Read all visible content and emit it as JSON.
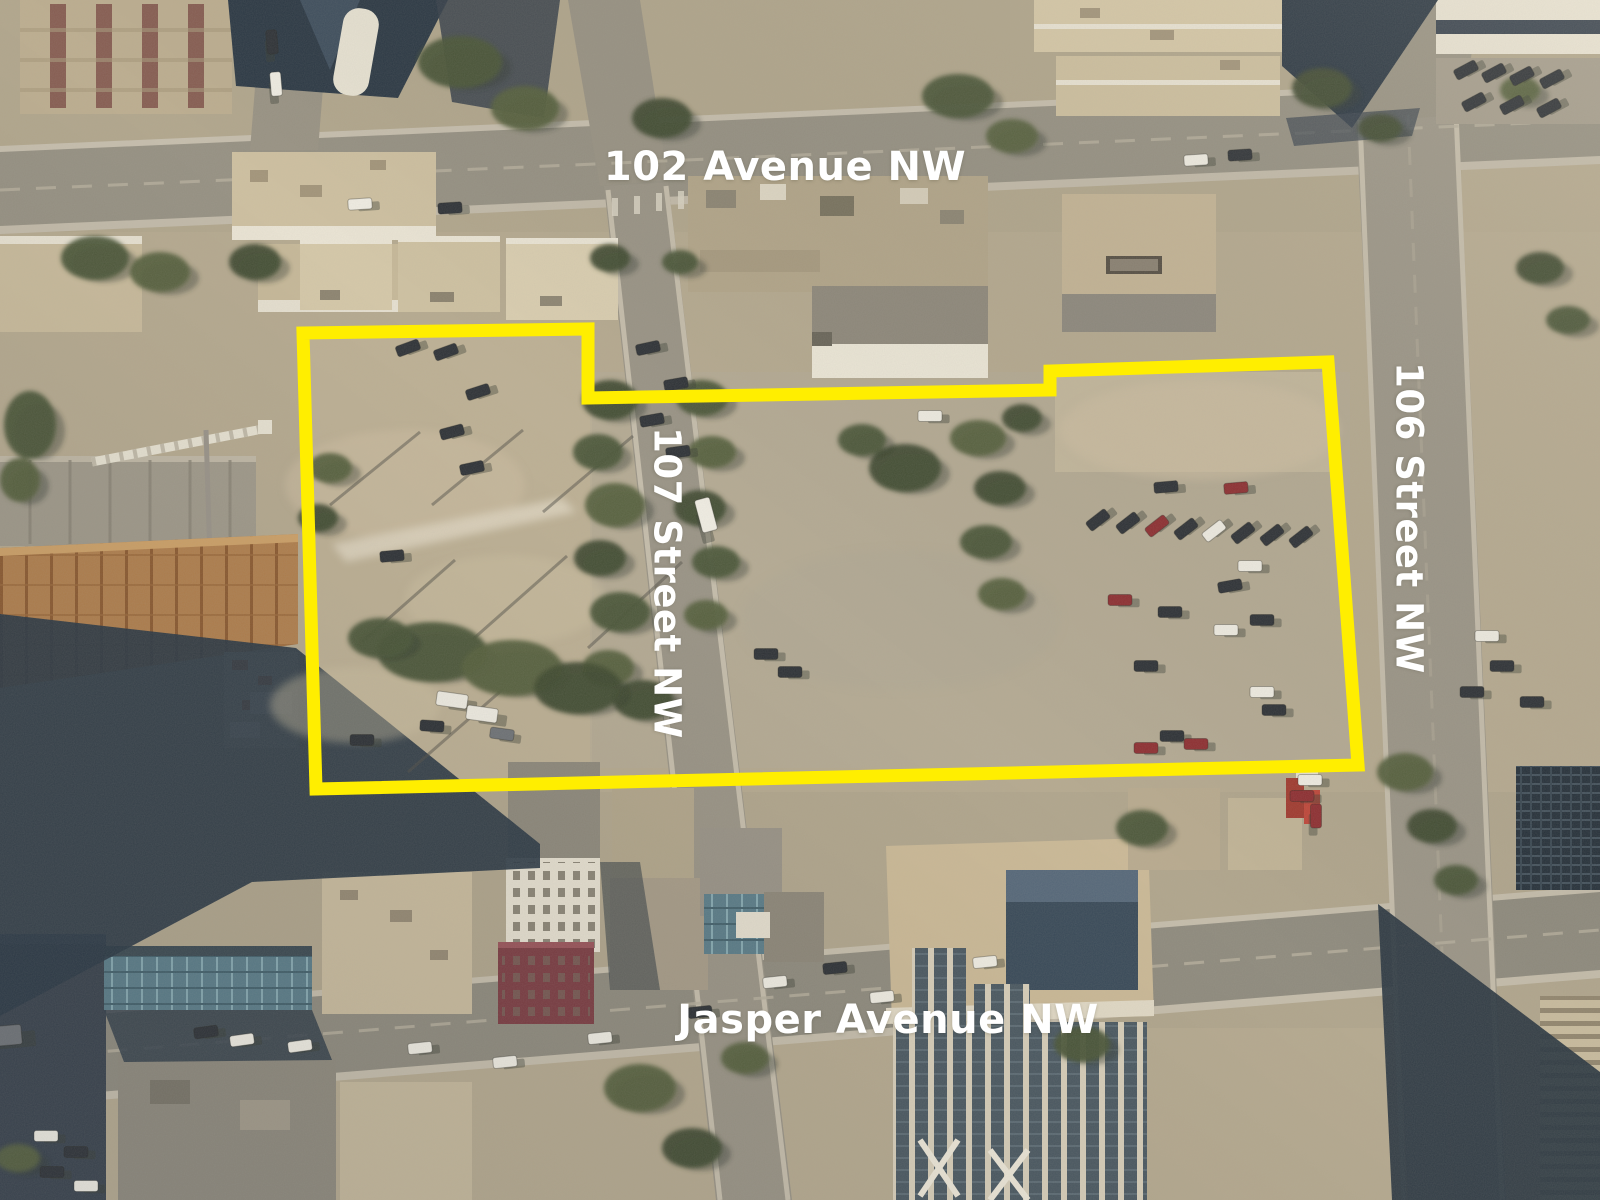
{
  "streets": {
    "avenue_102": {
      "label": "102 Avenue NW"
    },
    "street_107": {
      "label": "107 Street NW"
    },
    "street_106": {
      "label": "106 Street NW"
    },
    "jasper_avenue": {
      "label": "Jasper Avenue NW"
    }
  },
  "annotation": {
    "label_color": "#ffffff",
    "parcel_outline": {
      "color": "#ffee00",
      "stroke_width": 13,
      "points": "303,333 588,329 588,398 1050,390 1050,371 1328,362 1358,765 316,789"
    }
  }
}
